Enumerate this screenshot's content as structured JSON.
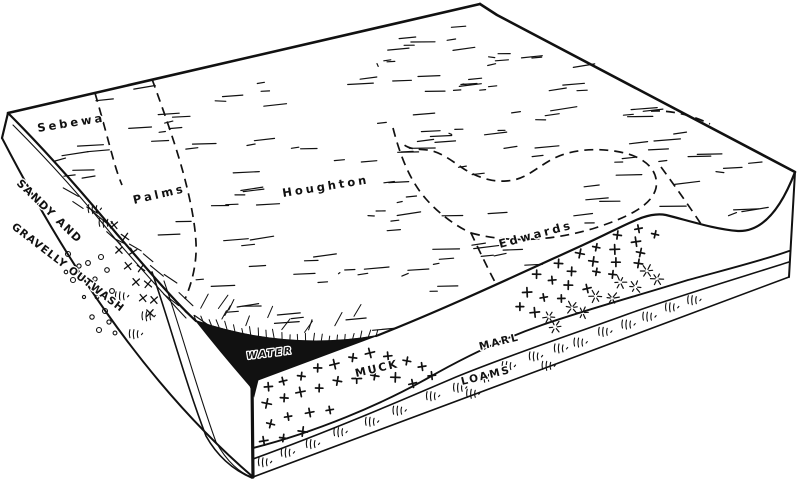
{
  "diagram": {
    "type": "soil-landscape block diagram",
    "colors": {
      "ink": "#111111",
      "paper": "#ffffff",
      "water_fill": "#111111"
    },
    "top_surface_labels": {
      "sebewa": "Sebewa",
      "palms": "Palms",
      "houghton": "Houghton",
      "edwards": "Edwards"
    },
    "cross_section_labels": {
      "outwash_line1": "SANDY AND",
      "outwash_line2": "GRAVELLY OUTWASH",
      "water": "WATER",
      "muck": "MUCK",
      "marl": "MARL",
      "loams": "LOAMS"
    },
    "symbols": {
      "plus_marks": "marl deposit symbol",
      "star_marks": "marl crystal symbol",
      "grass_tufts": "organic loam symbol",
      "circles": "gravel symbol",
      "x_marks": "sand symbol",
      "short_dashes": "muck surface texture",
      "hachures": "basin slope hachures"
    }
  }
}
